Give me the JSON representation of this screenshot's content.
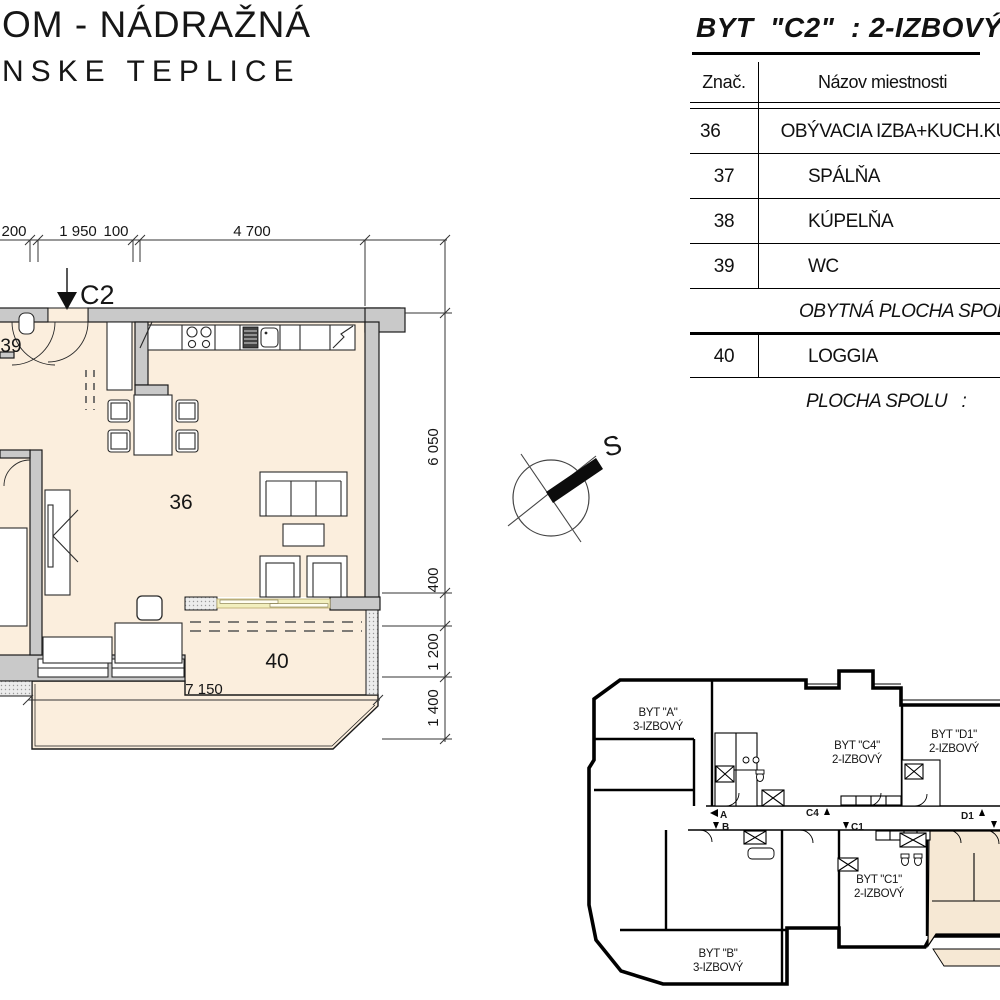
{
  "title": {
    "line1": "OM - NÁDRAŽNÁ",
    "line2": "NSKE TEPLICE"
  },
  "table": {
    "title": "BYT  \"C2\"  : 2-IZBOVÝ",
    "headers": {
      "code": "Znač.",
      "name": "Názov miestnosti"
    },
    "rows": [
      {
        "num": "36",
        "name": "OBÝVACIA IZBA+KUCH.KÚT"
      },
      {
        "num": "37",
        "name": "SPÁLŇA"
      },
      {
        "num": "38",
        "name": "KÚPELŇA"
      },
      {
        "num": "39",
        "name": "WC"
      },
      {
        "num": "",
        "name": "OBYTNÁ PLOCHA SPOLU"
      },
      {
        "num": "40",
        "name": "LOGGIA"
      },
      {
        "num": "",
        "name": "PLOCHA SPOLU   :"
      }
    ]
  },
  "plan": {
    "entrance_label": "C2",
    "rooms": {
      "living": "36",
      "wc": "39",
      "loggia": "40"
    },
    "dims": {
      "top": [
        "200",
        "1 950",
        "100",
        "4 700"
      ],
      "right": [
        "6 050",
        "400",
        "1 200",
        "1 400"
      ],
      "bottom": "7 150"
    }
  },
  "compass": {
    "north_label": "S"
  },
  "overview": {
    "apartments": [
      {
        "name": "BYT \"A\"",
        "type": "3-IZBOVÝ"
      },
      {
        "name": "BYT \"C4\"",
        "type": "2-IZBOVÝ"
      },
      {
        "name": "BYT \"D1\"",
        "type": "2-IZBOVÝ"
      },
      {
        "name": "BYT \"C1\"",
        "type": "2-IZBOVÝ"
      },
      {
        "name": "BYT \"B\"",
        "type": "3-IZBOVÝ"
      }
    ],
    "entrance_markers": [
      "A",
      "B",
      "C4",
      "C1",
      "D1"
    ]
  },
  "colors": {
    "floor": "#fbeedd",
    "wall": "#c9c9c9",
    "glazing": "#f2efbe",
    "highlight": "#f6e8d4"
  }
}
